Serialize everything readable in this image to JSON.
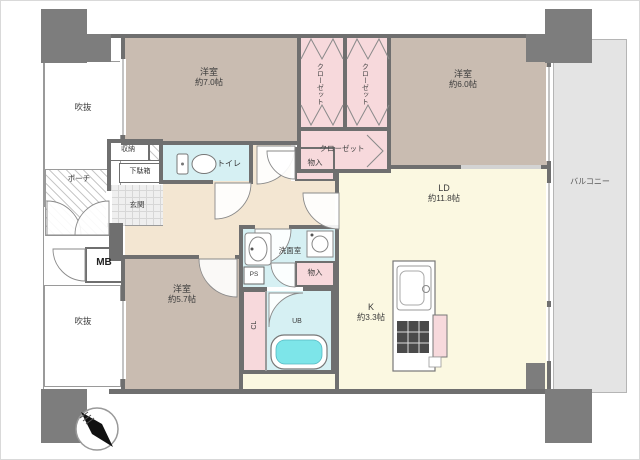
{
  "plan_title": "3LDK apartment floor plan",
  "rooms": {
    "bedroom_top_left": {
      "name": "洋室",
      "size": "約7.0帖"
    },
    "bedroom_top_right": {
      "name": "洋室",
      "size": "約6.0帖"
    },
    "bedroom_bottom": {
      "name": "洋室",
      "size": "約5.7帖"
    },
    "living_dining": {
      "name": "LD",
      "size": "約11.8帖"
    },
    "kitchen": {
      "name": "K",
      "size": "約3.3帖"
    },
    "balcony": {
      "name": "バルコニー"
    },
    "closet_left": {
      "name": "クローゼット"
    },
    "closet_right": {
      "name": "クローゼット"
    },
    "closet_lower": {
      "name": "クローゼット"
    },
    "storage_hall": {
      "name": "物入"
    },
    "storage_washroom": {
      "name": "物入"
    },
    "storage_shelf": {
      "name": "収納"
    },
    "shoe_cabinet": {
      "name": "下駄箱"
    },
    "entrance": {
      "name": "玄関"
    },
    "porch": {
      "name": "ポーチ"
    },
    "void_upper": {
      "name": "吹抜"
    },
    "void_lower": {
      "name": "吹抜"
    },
    "meter_box": {
      "name": "MB"
    },
    "toilet": {
      "name": "トイレ"
    },
    "washroom": {
      "name": "洗面室"
    },
    "closet_cl": {
      "name": "CL"
    },
    "unit_bath": {
      "name": "UB"
    },
    "pipe_space": {
      "name": "PS"
    }
  },
  "colors": {
    "bedroom": "#c9bcb1",
    "closet_pink": "#f7d9dc",
    "living_cream": "#fbf8e1",
    "wet_blue": "#d6f0f3",
    "hall_beige": "#f3e6d2",
    "balcony_grey": "#e4e4e4",
    "wall_grey": "#6f6f6f",
    "bathtub_cyan": "#7de5e9"
  }
}
